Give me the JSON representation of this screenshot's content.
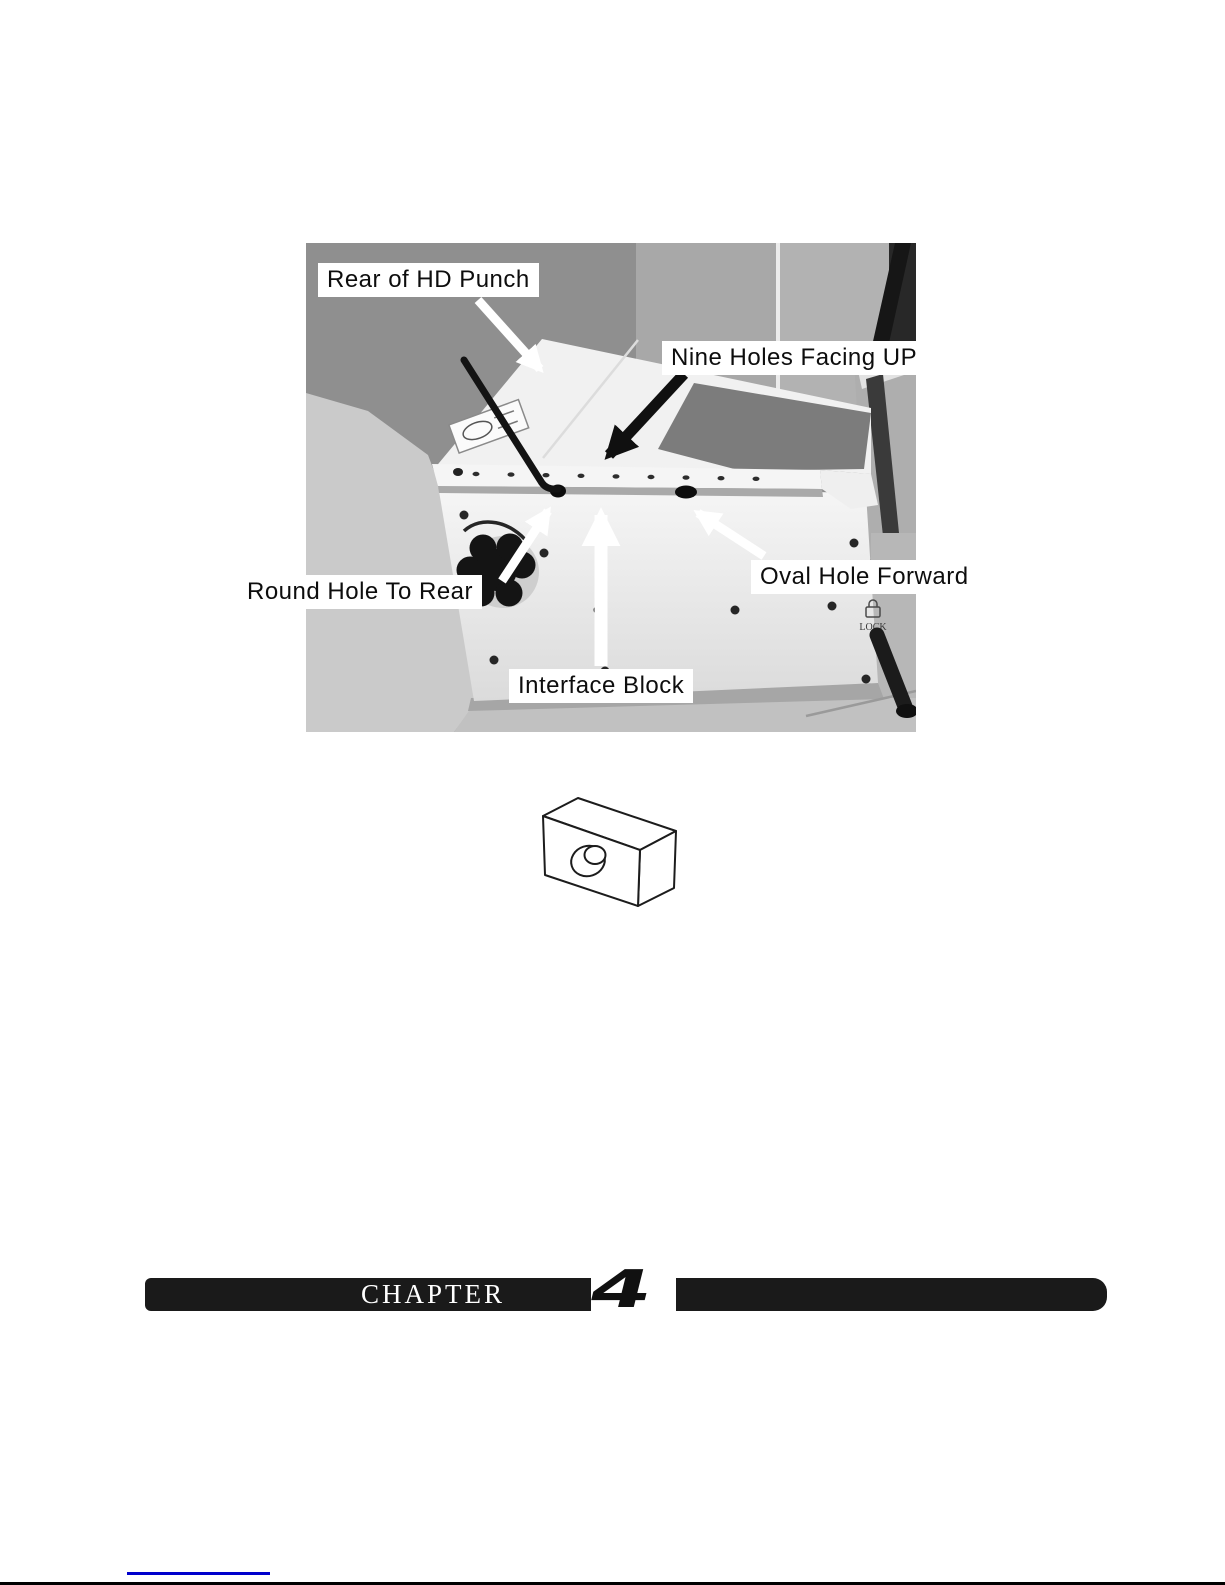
{
  "photo": {
    "callouts": [
      {
        "label": "Rear of HD Punch"
      },
      {
        "label": "Nine Holes Facing UP"
      },
      {
        "label": "Round Hole To Rear"
      },
      {
        "label": "Oval Hole Forward"
      },
      {
        "label": "Interface Block"
      }
    ],
    "markings": {
      "lock": "LOCK"
    }
  },
  "figure": {
    "icon": "interface-block-isometric-drawing"
  },
  "footer": {
    "chapter_label": "CHAPTER",
    "chapter_number": "4"
  },
  "colors": {
    "accent_blue": "#0000cc",
    "bar_black": "#1a1a1a",
    "wall_gray": "#8f8f8f"
  }
}
